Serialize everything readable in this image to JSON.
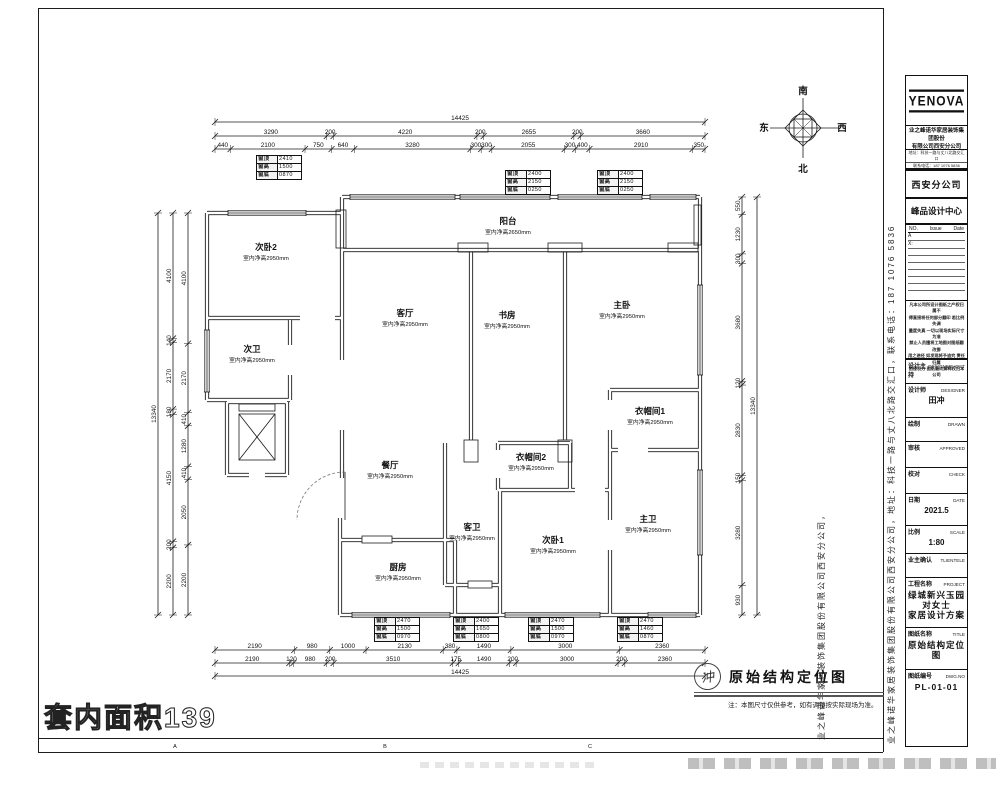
{
  "sheet": {
    "area_label": "套内面积139",
    "frame_letters": [
      "A",
      "B",
      "C"
    ],
    "caption": {
      "stamp": "冲",
      "title": "原始结构定位图",
      "note": "注：本图尺寸仅供参考，如有调整按实际现场为准。"
    },
    "compass": {
      "top": "南",
      "bottom": "北",
      "left": "东",
      "right": "西"
    },
    "side_text_full": "业之峰诺华家居装饰集团股份有限公司西安分公司，地址：科技一路与丈八北路交汇口，联系电话：187 1076 5836",
    "side_text_company": "业之峰诺华家居装饰集团股份有限公司西安分公司，"
  },
  "title_block": {
    "logo": "YENOVA",
    "company_lines": [
      "业之峰诺华家居装饰集团股份",
      "有限公司西安分公司"
    ],
    "contact_lines": [
      "地址：科技一路与丈八北路交汇口",
      "联系电话：187 1076 5836"
    ],
    "branch": "西安分公司",
    "center": "峰品设计中心",
    "revision": {
      "no": "NO.",
      "issue": "Issue",
      "date": "Date",
      "rows": [
        "A",
        "X:"
      ]
    },
    "disclaimer_lines": [
      "凡本公司所设计图纸之产权归属不",
      "得直接将任何部分翻印 若比例失调",
      "量度失真 一切以现场实际尺寸为准",
      "禁止人员擅将工地图对图纸翻改挪",
      "用之途径 如发现将予追究 责任归属",
      "由侵权方 图纸最终解释权归本公司"
    ],
    "fields": [
      {
        "label": "设计主持",
        "en": "DESIGNERHOST",
        "value": ""
      },
      {
        "label": "设计师",
        "en": "DESIGNER",
        "value": "田冲"
      },
      {
        "label": "绘制",
        "en": "DRAWN",
        "value": ""
      },
      {
        "label": "审核",
        "en": "APPROVED",
        "value": ""
      },
      {
        "label": "校对",
        "en": "CHECK",
        "value": ""
      },
      {
        "label": "日期",
        "en": "DATE",
        "value": "2021.5"
      },
      {
        "label": "比例",
        "en": "SCALE",
        "value": "1:80"
      },
      {
        "label": "业主确认",
        "en": "TLIENTELE",
        "value": ""
      },
      {
        "label": "工程名称",
        "en": "PROJECT",
        "value": "绿城新兴玉园对女士\n家居设计方案"
      },
      {
        "label": "图纸名称",
        "en": "TITLE",
        "value": "原始结构定位图"
      },
      {
        "label": "图纸编号",
        "en": "DWG.NO",
        "value": "PL-01-01"
      }
    ]
  },
  "floor_plan": {
    "rooms": [
      {
        "name": "次卧2",
        "sub": "室内净高2950mm",
        "x": 266,
        "y": 250
      },
      {
        "name": "次卫",
        "sub": "室内净高2950mm",
        "x": 252,
        "y": 352
      },
      {
        "name": "客厅",
        "sub": "室内净高2950mm",
        "x": 405,
        "y": 316
      },
      {
        "name": "阳台",
        "sub": "室内净高2650mm",
        "x": 508,
        "y": 224
      },
      {
        "name": "书房",
        "sub": "室内净高2950mm",
        "x": 507,
        "y": 318
      },
      {
        "name": "主卧",
        "sub": "室内净高2950mm",
        "x": 622,
        "y": 308
      },
      {
        "name": "衣帽间1",
        "sub": "室内净高2950mm",
        "x": 650,
        "y": 414
      },
      {
        "name": "衣帽间2",
        "sub": "室内净高2950mm",
        "x": 531,
        "y": 460
      },
      {
        "name": "餐厅",
        "sub": "室内净高2950mm",
        "x": 390,
        "y": 468
      },
      {
        "name": "客卫",
        "sub": "室内净高2950mm",
        "x": 472,
        "y": 530
      },
      {
        "name": "次卧1",
        "sub": "室内净高2950mm",
        "x": 553,
        "y": 543
      },
      {
        "name": "主卫",
        "sub": "室内净高2950mm",
        "x": 648,
        "y": 522
      },
      {
        "name": "厨房",
        "sub": "室内净高2950mm",
        "x": 398,
        "y": 570
      }
    ],
    "window_tables": [
      {
        "x": 256,
        "y": 155,
        "rows": [
          [
            "窗顶",
            "2410"
          ],
          [
            "窗高",
            "1500"
          ],
          [
            "窗底",
            "0870"
          ]
        ]
      },
      {
        "x": 505,
        "y": 170,
        "rows": [
          [
            "窗顶",
            "2400"
          ],
          [
            "窗高",
            "2150"
          ],
          [
            "窗底",
            "0250"
          ]
        ]
      },
      {
        "x": 597,
        "y": 170,
        "rows": [
          [
            "窗顶",
            "2400"
          ],
          [
            "窗高",
            "2150"
          ],
          [
            "窗底",
            "0250"
          ]
        ]
      },
      {
        "x": 374,
        "y": 617,
        "rows": [
          [
            "窗顶",
            "2470"
          ],
          [
            "窗高",
            "1500"
          ],
          [
            "窗底",
            "0970"
          ]
        ]
      },
      {
        "x": 453,
        "y": 617,
        "rows": [
          [
            "窗顶",
            "2400"
          ],
          [
            "窗高",
            "1650"
          ],
          [
            "窗底",
            "0800"
          ]
        ]
      },
      {
        "x": 528,
        "y": 617,
        "rows": [
          [
            "窗顶",
            "2470"
          ],
          [
            "窗高",
            "1500"
          ],
          [
            "窗底",
            "0970"
          ]
        ]
      },
      {
        "x": 617,
        "y": 617,
        "rows": [
          [
            "窗顶",
            "2470"
          ],
          [
            "窗高",
            "1460"
          ],
          [
            "窗底",
            "0870"
          ]
        ]
      }
    ],
    "dim_rows": [
      {
        "dir": "h",
        "y": 122,
        "a": 215,
        "b": 705,
        "values": [
          "14425"
        ]
      },
      {
        "dir": "h",
        "y": 136,
        "a": 215,
        "b": 705,
        "values": [
          "3290",
          "200",
          "4220",
          "200",
          "2655",
          "200",
          "3660"
        ]
      },
      {
        "dir": "h",
        "y": 149,
        "a": 215,
        "b": 705,
        "values": [
          "440",
          "2100",
          "750",
          "640",
          "3280",
          "300",
          "300",
          "2055",
          "300",
          "400",
          "2910",
          "350"
        ]
      },
      {
        "dir": "h",
        "y": 650,
        "a": 215,
        "b": 705,
        "values": [
          "2190",
          "980",
          "1000",
          "2130",
          "380",
          "1490",
          "3000",
          "2360"
        ]
      },
      {
        "dir": "h",
        "y": 663,
        "a": 215,
        "b": 705,
        "values": [
          "2190",
          "120",
          "980",
          "200",
          "3510",
          "175",
          "1490",
          "200",
          "3000",
          "200",
          "2360"
        ]
      },
      {
        "dir": "h",
        "y": 676,
        "a": 215,
        "b": 705,
        "values": [
          "14425"
        ]
      },
      {
        "dir": "v",
        "x": 158,
        "a": 213,
        "b": 615,
        "values": [
          "13340"
        ]
      },
      {
        "dir": "v",
        "x": 173,
        "a": 213,
        "b": 615,
        "values": [
          "4100",
          "140",
          "2170",
          "180",
          "4150",
          "200",
          "2200"
        ]
      },
      {
        "dir": "v",
        "x": 188,
        "a": 213,
        "b": 615,
        "values": [
          "4100",
          "2170",
          "410",
          "1280",
          "410",
          "2050",
          "2200"
        ]
      },
      {
        "dir": "v",
        "x": 742,
        "a": 197,
        "b": 615,
        "values": [
          "550",
          "1230",
          "300",
          "3680",
          "120",
          "2830",
          "150",
          "3280",
          "930"
        ]
      },
      {
        "dir": "v",
        "x": 757,
        "a": 197,
        "b": 615,
        "values": [
          "13340"
        ]
      }
    ]
  }
}
